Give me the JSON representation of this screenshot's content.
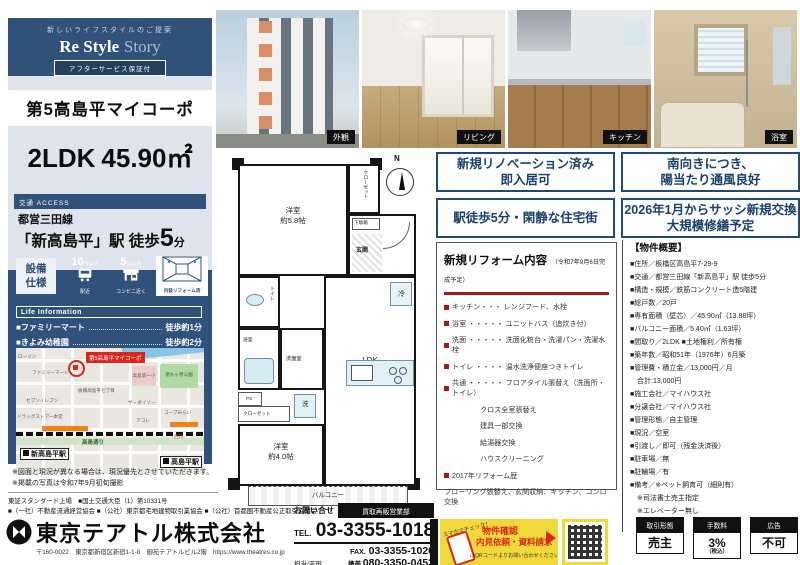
{
  "theme": {
    "navy": "#30517a",
    "light": "#dfe3eb",
    "red": "#9e1b23",
    "marker_red": "#d9261f",
    "yellow": "#f2d93b"
  },
  "sidebar": {
    "tagline": "新しいライフスタイルのご提案",
    "logo_main": "Re Style",
    "logo_sub": "Story",
    "badge": "アフターサービス保証付",
    "property_name": "第5高島平マイコーポ",
    "layout": "2LDK",
    "area": "45.90㎡",
    "access_header": "交通 ACCESS",
    "rail_line": "都営三田線",
    "station_main": "「新高島平」駅 徒歩",
    "station_num": "5",
    "station_unit": "分",
    "equipment_title_1": "設備",
    "equipment_title_2": "仕様",
    "equip": [
      {
        "num": "10",
        "unit": "分以内",
        "label": "駅近"
      },
      {
        "num": "5",
        "unit": "分以内",
        "label": "コンビニ近く"
      },
      {
        "label": "内装リフォーム済"
      }
    ],
    "life_title": "Life Information",
    "life": [
      {
        "name": "■ファミリーマート",
        "value": "徒歩約1分"
      },
      {
        "name": "■きよみ幼稚園",
        "value": "徒歩約2分"
      }
    ],
    "map": {
      "marker": "第5高島平マイコーポ",
      "station_west": "新高島平駅",
      "station_east": "高島平駅",
      "road": "高島通り",
      "exit_west": "西口",
      "pois": [
        "ローソン",
        "ファミリーマート",
        "セブンイレブン",
        "ドラッグストアー本堂",
        "高島第一小",
        "徳丸ヶ原公園",
        "ザ・ダイソー",
        "アコレ",
        "コープみらい",
        "板橋高島平七丁目"
      ]
    },
    "notes": [
      "※図面と現況が異なる場合は、現況優先とさせていただきます。",
      "※掲載の写真は令和7年9月初旬撮影"
    ]
  },
  "photos": {
    "labels": [
      "外観",
      "リビング",
      "キッチン",
      "浴室"
    ]
  },
  "floorplan": {
    "compass": "N",
    "rooms": {
      "west1a": "洋室",
      "west1b": "約5.8帖",
      "closet1": "クローゼット",
      "shoe": "下駄箱",
      "entrance": "玄関",
      "toilet": "トイレ",
      "bath": "浴室",
      "powder": "洗面室",
      "fridge": "冷",
      "ps": "PS",
      "closet2": "クローゼット",
      "laundry": "洗",
      "ldka": "LDK",
      "ldkb": "約12.0帖",
      "west2a": "洋室",
      "west2b": "約4.0帖",
      "balcony": "バルコニー"
    }
  },
  "features": [
    {
      "line1": "新規リノベーション済み",
      "line2": "即入居可"
    },
    {
      "line1": "南向きにつき、",
      "line2": "陽当たり通風良好"
    },
    {
      "line1": "駅徒歩5分・閑静な住宅街",
      "line2": ""
    },
    {
      "line1": "2026年1月からサッシ新規交換",
      "line2": "大規模修繕予定"
    }
  ],
  "reform": {
    "title": "新規リフォーム内容",
    "subtitle": "（令和7年9月6日完成予定）",
    "items": [
      {
        "text": "キッチン・・・ レンジフード、水栓"
      },
      {
        "text": "浴室 ・・・・・ ユニットバス（追炊き付）"
      },
      {
        "text": "洗面 ・・・・・ 洗面化粧台・洗濯パン・洗濯水栓"
      },
      {
        "text": "トイレ ・・・・ 温水洗浄便座つきトイレ"
      },
      {
        "text": "共通 ・・・・・ フロアタイル張替え（洗面所・トイレ）"
      },
      {
        "text": "クロス全室張替え"
      },
      {
        "text": "建具一部交換"
      },
      {
        "text": "給湯器交換"
      },
      {
        "text": "ハウスクリーニング"
      },
      {
        "text": "2017年リフォーム歴"
      },
      {
        "text": "フローリング張替え、玄関収納、キッチン、コンロ交換"
      }
    ]
  },
  "outline": {
    "title": "【物件概要】",
    "items": [
      "■住所／板橋区高島平7-29-9",
      "■交通／都営三田線「新高島平」駅 徒歩5分",
      "■構造・規模／鉄筋コンクリート造5階建",
      "■総戸数／20戸",
      "■専有面積（壁芯）／45.90㎡（13.88坪）",
      "■バルコニー面積／5.40㎡（1.63坪）",
      "■間取り／2LDK ■土地権利／所有権",
      "■築年数／昭和51年（1976年）6月築",
      "■管理費・積立金／13,000円／月",
      "　合計:13,000円",
      "■施工会社／マイハウス社",
      "■分譲会社／マイハウス社",
      "■管理形態／自主管理",
      "■現況／空室",
      "■引渡し／即可（残金決済後）",
      "■駐車場／無",
      "■駐輪場／有",
      "■備考／※ペット飼育可（細則有）",
      "　※司法書士売主指定",
      "　※エレベーター無し",
      "　※告知事項あり"
    ]
  },
  "contact": {
    "inquiry_label": "お問い合せ",
    "dept": "買取再販営業部",
    "tel_label": "TEL.",
    "tel": "03-3355-1018",
    "fax_label": "FAX.",
    "fax": "03-3355-1020",
    "staff": "担当/吉田",
    "mobile_label": "携帯.",
    "mobile": "080-3350-0453"
  },
  "promo": {
    "check": "スマホでチェック！",
    "line1": "物件確認",
    "line2": "内見依頼・資料請求",
    "note": "はQRコードよりお問い合わせください。"
  },
  "terms": [
    {
      "label": "取引形態",
      "value": "売主",
      "note": ""
    },
    {
      "label": "手数料",
      "value": "3%",
      "note": "（税込）"
    },
    {
      "label": "広告",
      "value": "不可",
      "note": ""
    }
  ],
  "company": {
    "listing": "東証スタンダード上場　■国土交通大臣（1）第10331号",
    "associations": "■（一社）不動産流通経営協会 ■（公社）東京都宅地建物取引業協会 ■（公社）首都圏不動産公正取引協議会",
    "name": "東京テアトル株式会社",
    "address": "〒160-0022　東京都新宿区新宿1-1-8　御苑テアトルビル2階　https://www.theatres.co.jp"
  }
}
